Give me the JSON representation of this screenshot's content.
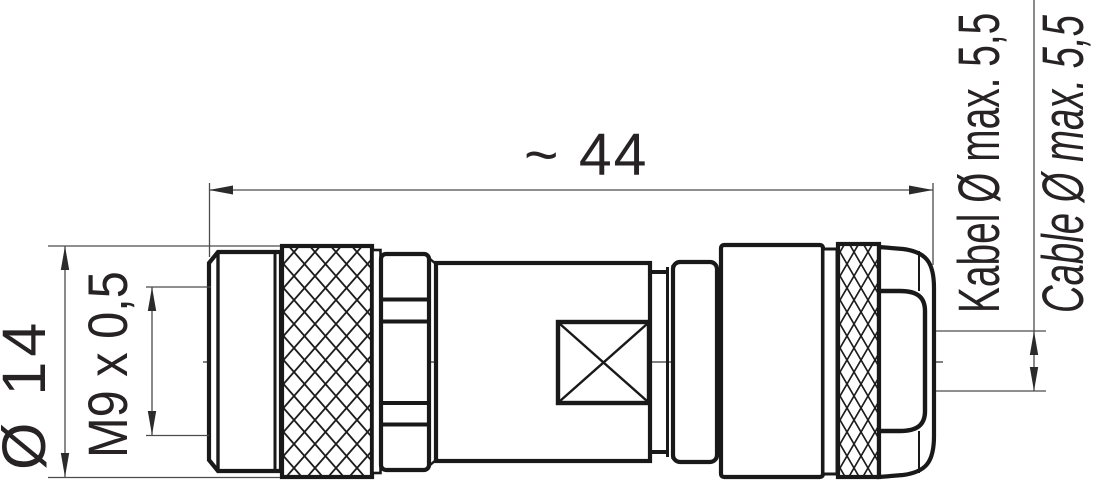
{
  "labels": {
    "length": "~ 44",
    "outer_diameter": "Ø 14",
    "thread": "M9 x 0,5",
    "cable_diameter_de": "Kabel Ø max. 5,5",
    "cable_diameter_en": "Cable Ø max. 5,5"
  },
  "colors": {
    "outline": "#191919",
    "dimension_lines": "#4c4c4c",
    "text": "#272324",
    "background": "#ffffff"
  }
}
